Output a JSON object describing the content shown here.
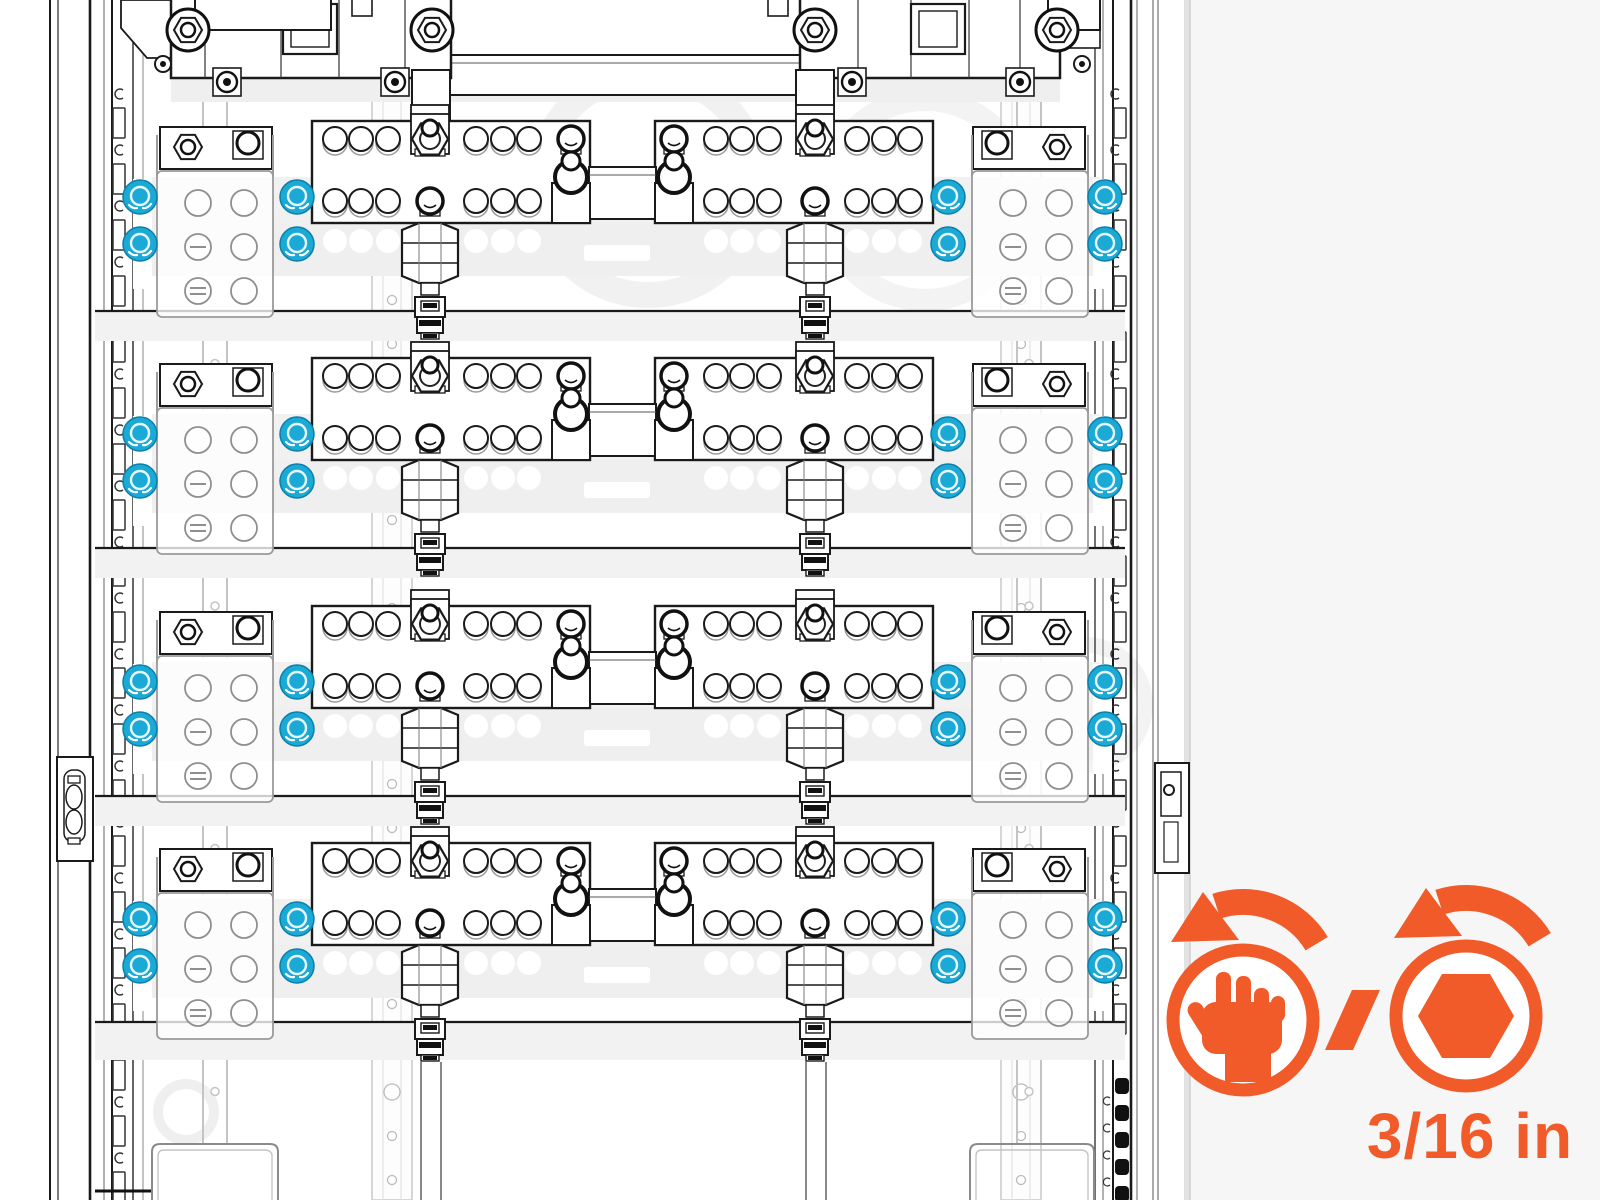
{
  "callout": {
    "hand_icon_meaning": "hand-tighten",
    "separator": "/",
    "tool_icon_meaning": "hex-socket-tighten",
    "size_label": "3/16 in"
  },
  "colors": {
    "accent_orange": "#F15A29",
    "highlight_blue": "#1BA9D6",
    "highlight_blue_edge": "#0B7FA9",
    "line_dark": "#1A1A1A",
    "page_bg": "#F6F6F6"
  },
  "diagram": {
    "busbar_rows": 4,
    "plates_per_row": 2,
    "holes_per_plate_section": 3,
    "terminal_blocks_per_row": 2,
    "highlighted_nuts_total": 32,
    "highlighted_nut_columns": 4
  }
}
